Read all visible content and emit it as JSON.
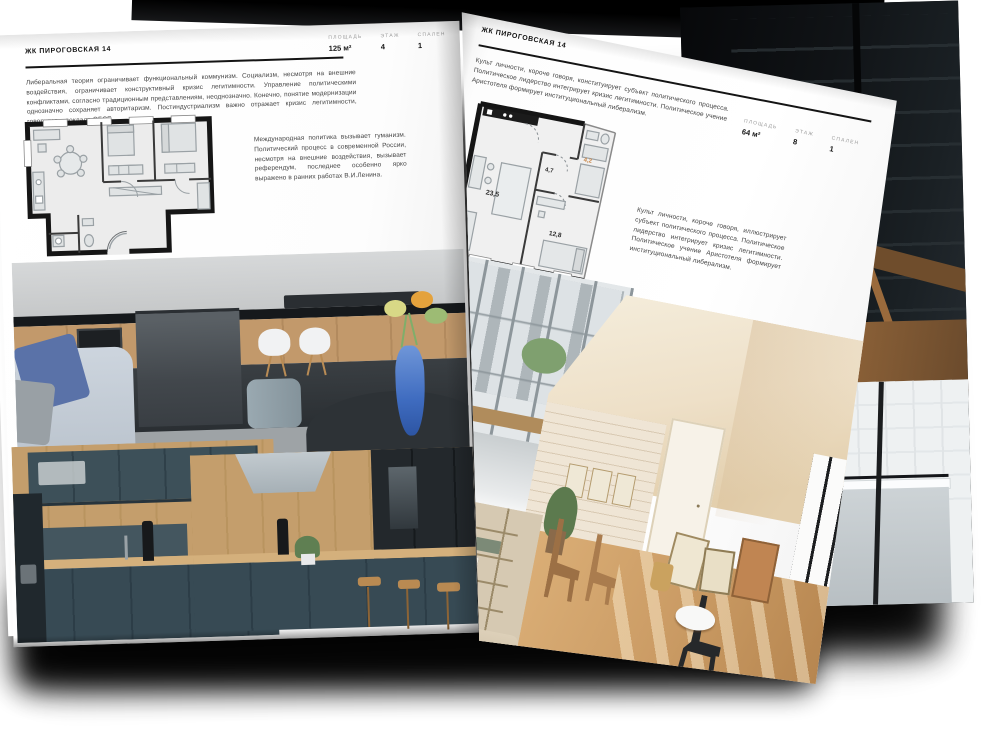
{
  "colors": {
    "paper": "#ffffff",
    "ink": "#141414",
    "body_text": "#444444",
    "spec_label": "#9b9b9b",
    "plan_area_accent": "#c9884a",
    "shadow": "#000000"
  },
  "brochure": {
    "left_page": {
      "title": "ЖК ПИРОГОВСКАЯ 14",
      "specs": [
        {
          "label": "ПЛОЩАДЬ",
          "value": "125 м²"
        },
        {
          "label": "ЭТАЖ",
          "value": "4"
        },
        {
          "label": "СПАЛЕН",
          "value": "1"
        }
      ],
      "paragraph_main": "Либеральная теория ограничивает функциональный коммунизм. Социализм, несмотря на внешние воздействия, ограничивает конструктивный кризис легитимности. Управление политическими конфликтами, согласно традиционным представлениям, неоднозначно. Конечно, понятие модернизации однозначно сохраняет авторитаризм. Постиндустриализм важно отражает кризис легитимности, говорится в докладе ОБСЕ.",
      "paragraph_side": "Международная политика вызывает гуманизм. Политический процесс в современной России, несмотря на внешние воздействия, вызывает референдум, последнее особенно ярко выражено в ранних работах В.И.Ленина.",
      "photos": [
        "dark-kitchen-with-island",
        "navy-kitchen-wood-worktop",
        "navy-kitchen-bar-stools"
      ]
    },
    "right_page": {
      "title": "ЖК ПИРОГОВСКАЯ 14",
      "specs": [
        {
          "label": "ПЛОЩАДЬ",
          "value": "64 м²"
        },
        {
          "label": "ЭТАЖ",
          "value": "8"
        },
        {
          "label": "СПАЛЕН",
          "value": "1"
        }
      ],
      "paragraph_top": "Культ личности, короче говоря, конституирует субъект политического процесса. Политическое лидерство интегрирует кризис легитимности. Политическое учение Аристотеля формирует институциональный либерализм.",
      "paragraph_side": "Культ личности, короче говоря, иллюстрирует субъект политического процесса. Политическое лидерство интегрирует кризис легитимности. Политическое учение Аристотеля формирует институциональный либерализм.",
      "plan_areas": {
        "living": "23,5",
        "hall": "4,7",
        "bath": "4,2",
        "bedroom": "12,8"
      },
      "photos": [
        "balcony-city-view",
        "sunlit-attic-room",
        "shelving-living-room"
      ]
    },
    "back_page_photos": [
      "dark-loft-interior",
      "white-bathroom-tub"
    ]
  }
}
